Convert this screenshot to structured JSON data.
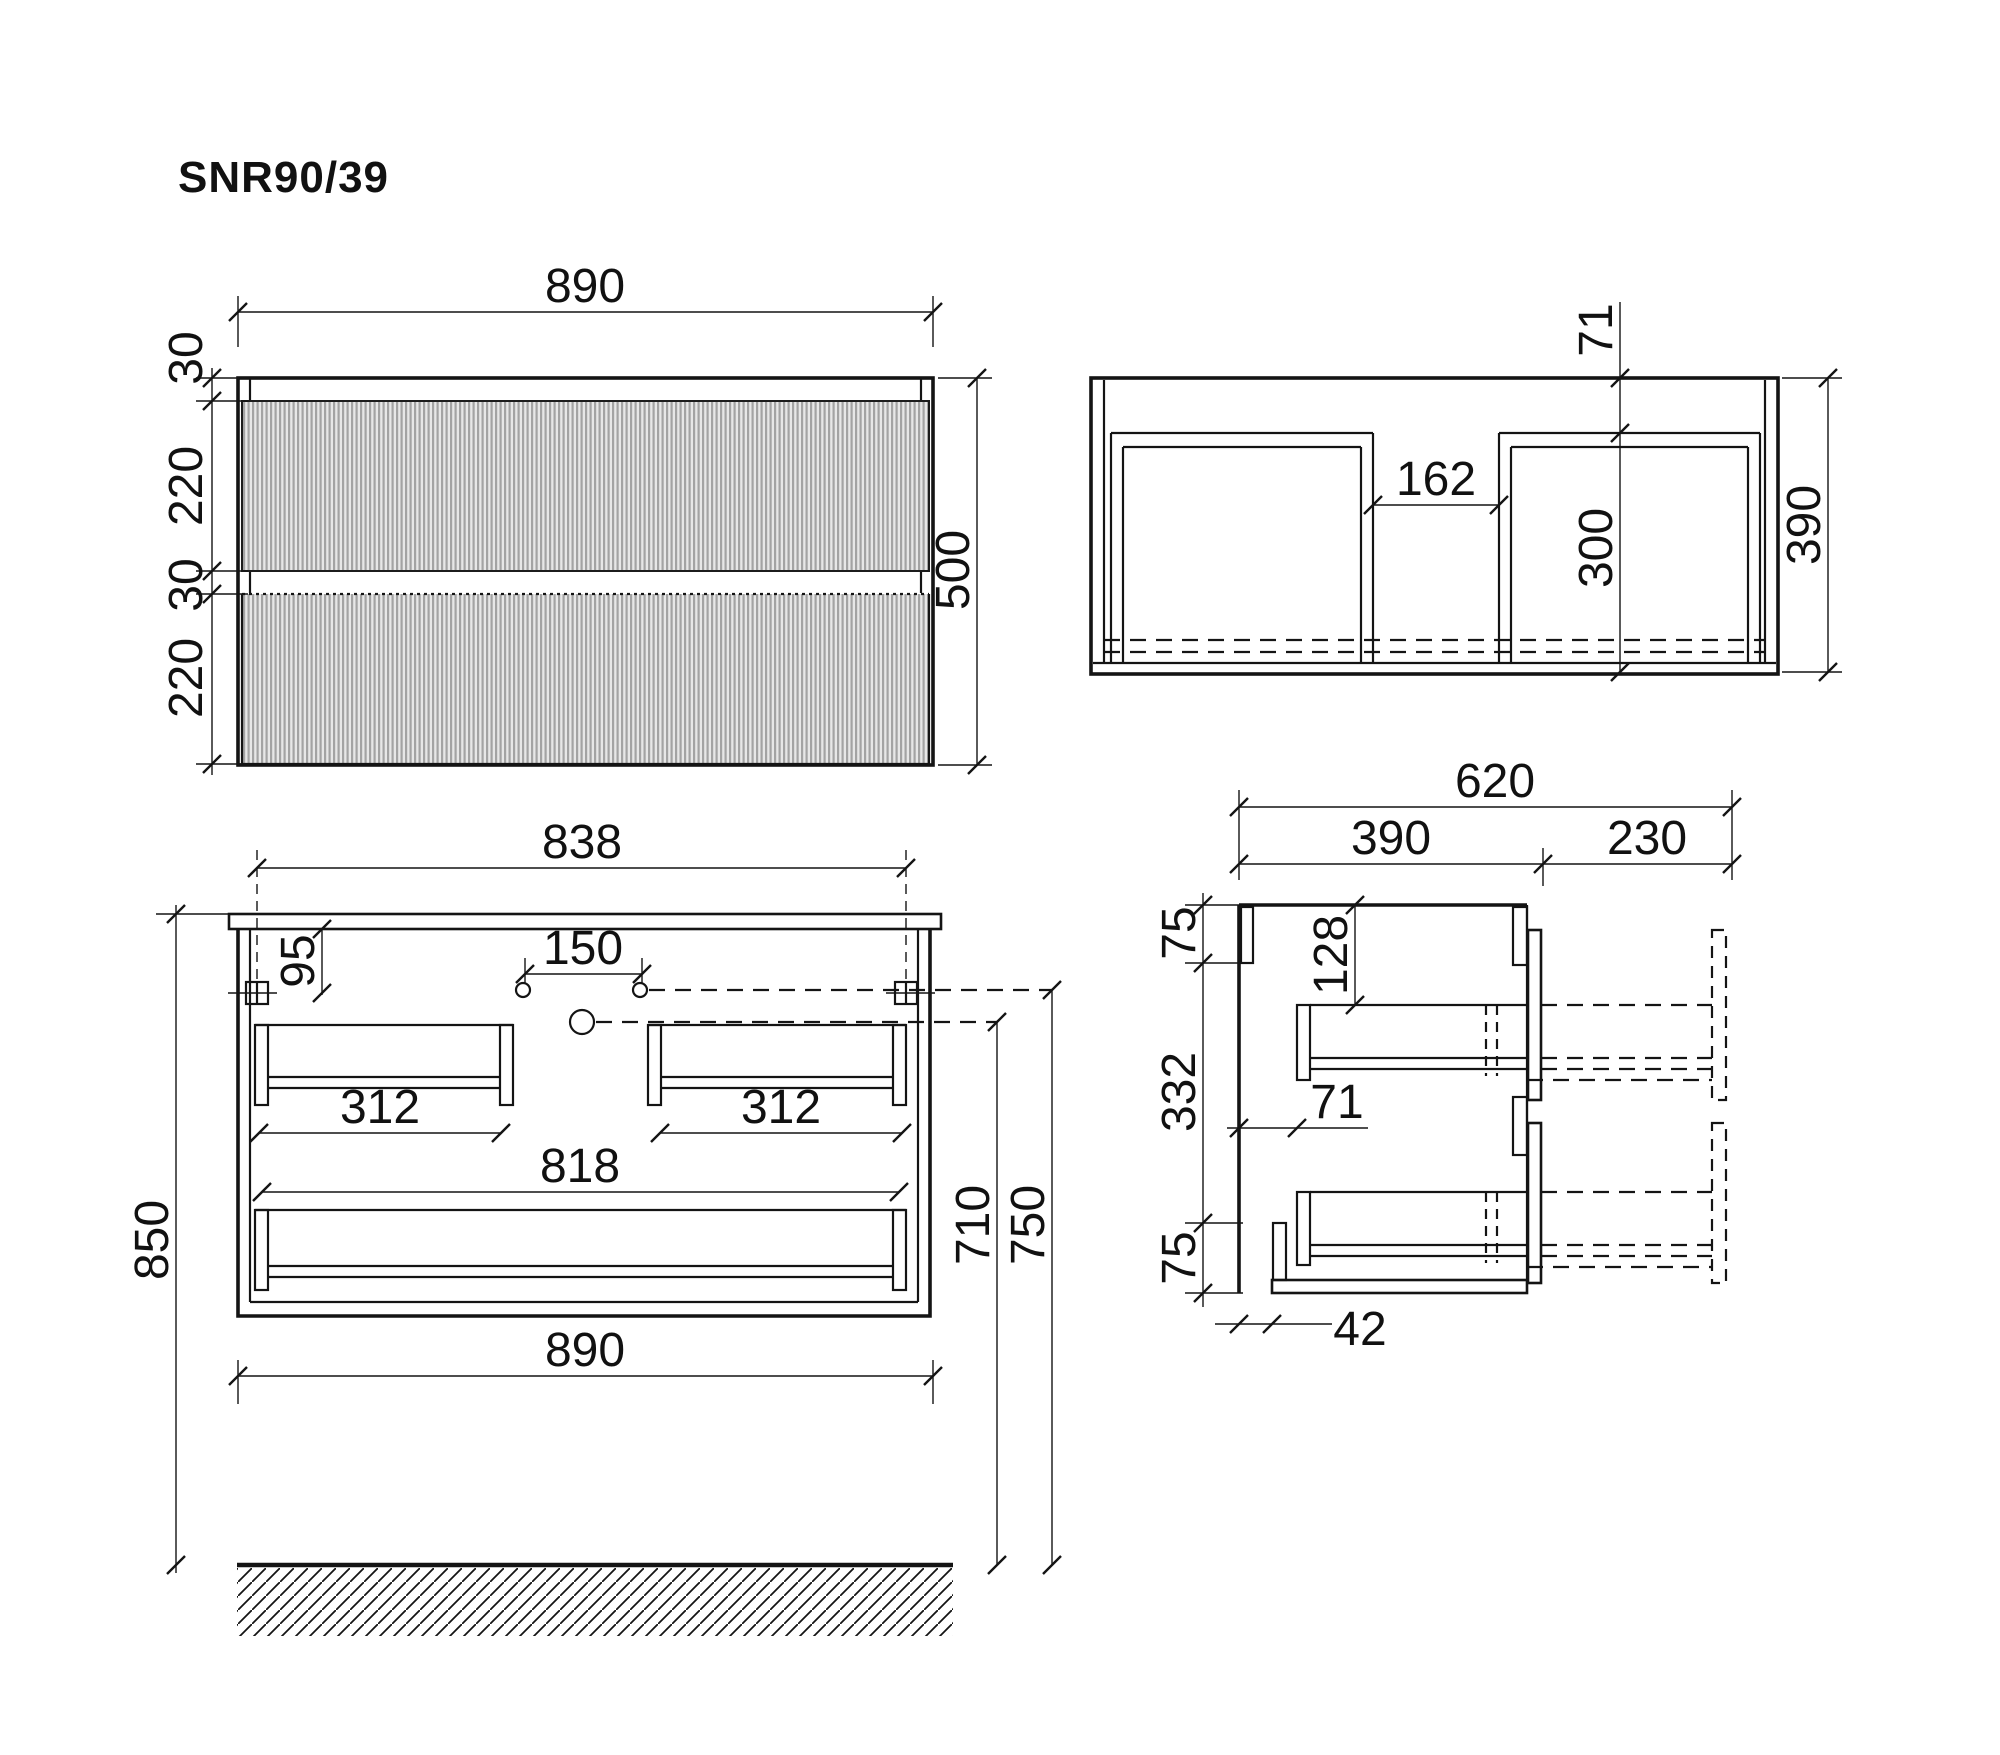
{
  "title": "SNR90/39",
  "colors": {
    "line": "#141414",
    "flute_stripe": "#a3a3a3",
    "flute_bg": "#e7e7e7"
  },
  "front_view": {
    "width": "890",
    "height": "500",
    "top_gap": "30",
    "upper_front": "220",
    "middle_gap": "30",
    "lower_front": "220"
  },
  "plan_view": {
    "top_offset": "71",
    "center_gap": "162",
    "inner_depth": "300",
    "total_depth": "390"
  },
  "elevation_view": {
    "bracket_span": "838",
    "bracket_offset": "95",
    "faucet_holes": "150",
    "rail_left": "312",
    "rail_right": "312",
    "rail_bottom": "818",
    "total_width": "890",
    "mounting_height": "850",
    "drain_height": "710",
    "holes_height": "750"
  },
  "side_view": {
    "extended_depth": "620",
    "body_depth": "390",
    "drawer_travel": "230",
    "top_margin": "75",
    "rail_top_offset": "128",
    "mid_span": "332",
    "rail_back_offset": "71",
    "bottom_margin": "75",
    "bottom_inset": "42"
  }
}
